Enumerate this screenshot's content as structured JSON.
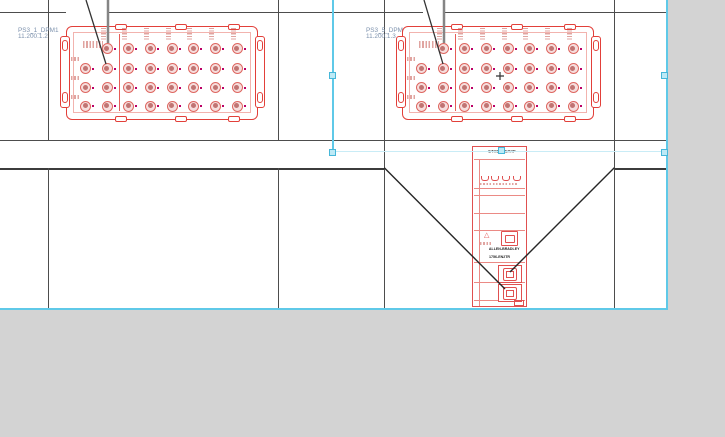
{
  "canvas": {
    "device_tags": {
      "left": {
        "name": "PS3_1_DPM1",
        "ip": "11.200.1.2"
      },
      "right": {
        "name": "PS3_5_DPM1",
        "ip": "11.200.1.3"
      }
    },
    "ethernet_module": {
      "protocol_label": "ETHERNET/IP",
      "brand": "ALLEN-BRADLEY",
      "model": "1756-EN2TR"
    }
  },
  "colors": {
    "component_red": "#e2403a",
    "selection_cyan": "#5fc9e8",
    "tag_blue": "#7d92ad",
    "grid_line": "#4d4d4d",
    "app_background": "#d3d3d3",
    "sheet_white": "#ffffff"
  }
}
